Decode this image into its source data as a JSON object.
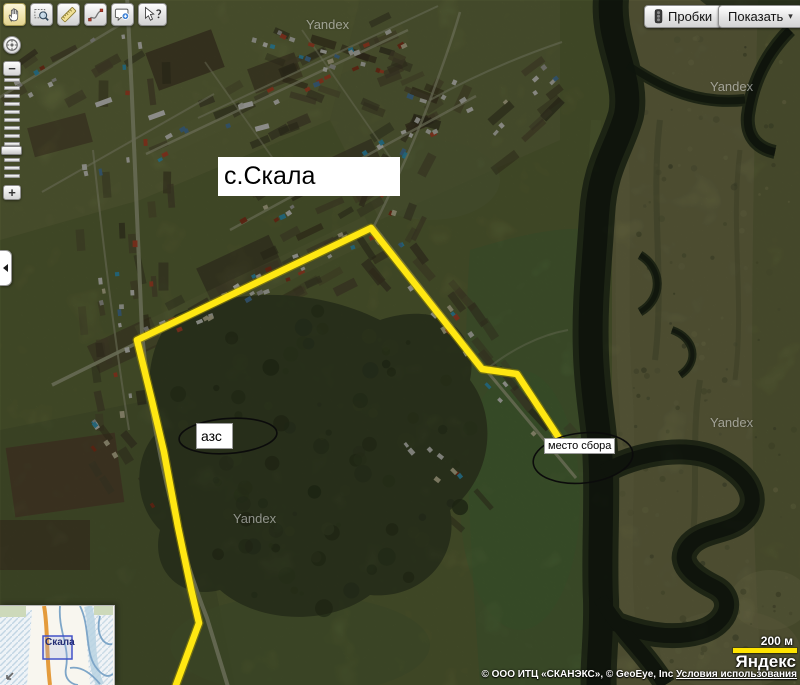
{
  "toolbar": {
    "icons": [
      "hand-icon",
      "zoom-area-icon",
      "ruler-icon",
      "route-icon",
      "add-balloon-icon",
      "help-cursor-icon"
    ],
    "selected_tool": "hand"
  },
  "zoom_control": {
    "out": "−",
    "in": "+",
    "locate_icon": "compass-icon"
  },
  "panel_toggle": {
    "icon": "chevron-left-icon"
  },
  "buttons": {
    "traffic": {
      "label": "Пробки",
      "icon": "traffic-light-icon"
    },
    "show": {
      "label": "Показать",
      "arrow": "▾"
    }
  },
  "map": {
    "title_label": "с.Скала",
    "watermark": "Yandex",
    "route_color": "#ffe712",
    "annotations": {
      "gas": {
        "label": "азс"
      },
      "meeting": {
        "label": "место сбора"
      }
    }
  },
  "minimap": {
    "viewport_label": "Скала",
    "collapse_icon": "collapse-arrow-icon"
  },
  "attribution": {
    "scale": "200 м",
    "brand": "Яндекс",
    "copyright": "© ООО ИТЦ «СКАНЭКС», © GeoEye, Inc",
    "terms": "Условия использования"
  }
}
